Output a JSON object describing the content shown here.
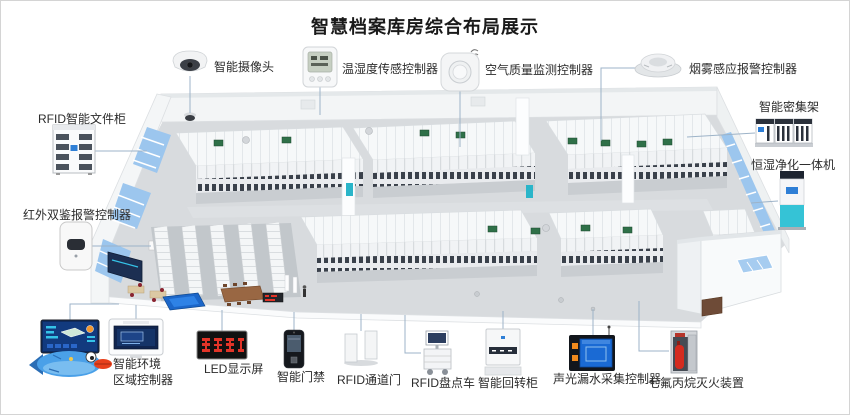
{
  "title": "智慧档案库房综合布局展示",
  "devices": [
    {
      "id": "smart-camera",
      "label": "智能摄像头"
    },
    {
      "id": "temp-humidity-controller",
      "label": "温湿度传感控制器"
    },
    {
      "id": "air-quality-controller",
      "label": "空气质量监测控制器"
    },
    {
      "id": "smoke-alarm-controller",
      "label": "烟雾感应报警控制器"
    },
    {
      "id": "smart-compact-shelving",
      "label": "智能密集架"
    },
    {
      "id": "humidity-purifier-unit",
      "label": "恒湿净化一体机"
    },
    {
      "id": "rfid-file-cabinet",
      "label": "RFID智能文件柜"
    },
    {
      "id": "infrared-alarm-controller",
      "label": "红外双鉴报警控制器"
    },
    {
      "id": "env-zone-controller",
      "label": "智能环境\n区域控制器"
    },
    {
      "id": "led-display",
      "label": "LED显示屏"
    },
    {
      "id": "smart-access-control",
      "label": "智能门禁"
    },
    {
      "id": "rfid-gate",
      "label": "RFID通道门"
    },
    {
      "id": "rfid-inventory-cart",
      "label": "RFID盘点车"
    },
    {
      "id": "smart-rotary-cabinet",
      "label": "智能回转柜"
    },
    {
      "id": "leak-detector-controller",
      "label": "声光漏水采集控制器"
    },
    {
      "id": "fire-suppression-device",
      "label": "七氟丙烷灭火装置"
    }
  ],
  "colors": {
    "connector_line": "#9db3c8",
    "window_blue": "#9cc6ee",
    "led_red": "#e23428",
    "purifier_cyan": "#35c3d6",
    "dashboard_navy": "#123a7e",
    "fish_blue": "#4aa0e8",
    "panel_green": "#2f7048",
    "floor_gray": "#d8dbde"
  }
}
